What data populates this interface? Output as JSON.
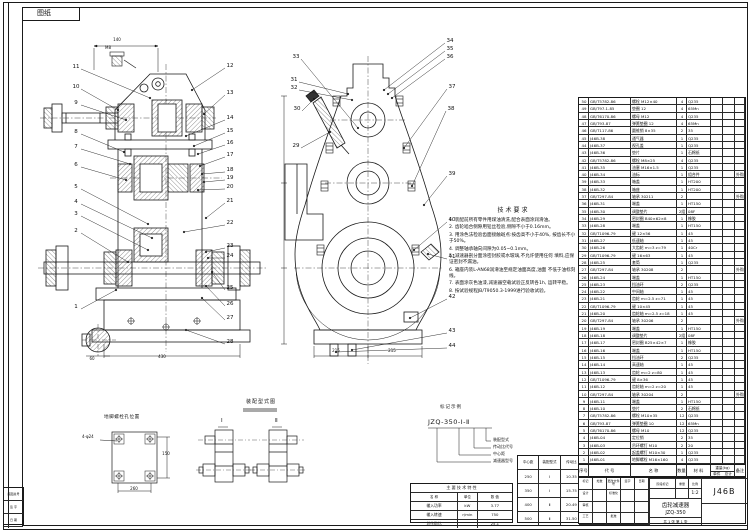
{
  "sheet": {
    "corner_tab": "图纸",
    "bottom_left_rows": [
      "底图总号",
      "签 字",
      "日 期"
    ],
    "line_color": "#1a1a1a",
    "paper_color": "#ffffff"
  },
  "front_view": {
    "name": "减速器主视剖视图",
    "detail_label": "M8",
    "callouts_left": [
      {
        "n": "11",
        "x": 76,
        "y": 68,
        "tx": 150,
        "ty": 98
      },
      {
        "n": "10",
        "x": 76,
        "y": 88,
        "tx": 118,
        "ty": 110
      },
      {
        "n": "9",
        "x": 76,
        "y": 104,
        "tx": 126,
        "ty": 120
      },
      {
        "n": "8",
        "x": 76,
        "y": 133,
        "tx": 124,
        "ty": 152
      },
      {
        "n": "7",
        "x": 76,
        "y": 148,
        "tx": 130,
        "ty": 164
      },
      {
        "n": "6",
        "x": 76,
        "y": 166,
        "tx": 126,
        "ty": 180
      },
      {
        "n": "5",
        "x": 76,
        "y": 188,
        "tx": 148,
        "ty": 224
      },
      {
        "n": "4",
        "x": 76,
        "y": 203,
        "tx": 152,
        "ty": 238
      },
      {
        "n": "3",
        "x": 76,
        "y": 215,
        "tx": 148,
        "ty": 250
      },
      {
        "n": "2",
        "x": 76,
        "y": 232,
        "tx": 128,
        "ty": 262
      },
      {
        "n": "1",
        "x": 76,
        "y": 308,
        "tx": 116,
        "ty": 290
      }
    ],
    "callouts_right": [
      {
        "n": "12",
        "x": 230,
        "y": 67,
        "tx": 192,
        "ty": 90
      },
      {
        "n": "13",
        "x": 230,
        "y": 94,
        "tx": 204,
        "ty": 114
      },
      {
        "n": "14",
        "x": 230,
        "y": 119,
        "tx": 186,
        "ty": 136
      },
      {
        "n": "15",
        "x": 230,
        "y": 132,
        "tx": 194,
        "ty": 146
      },
      {
        "n": "16",
        "x": 230,
        "y": 144,
        "tx": 198,
        "ty": 154
      },
      {
        "n": "17",
        "x": 230,
        "y": 156,
        "tx": 200,
        "ty": 166
      },
      {
        "n": "18",
        "x": 230,
        "y": 171,
        "tx": 202,
        "ty": 174
      },
      {
        "n": "19",
        "x": 230,
        "y": 179,
        "tx": 204,
        "ty": 182
      },
      {
        "n": "20",
        "x": 230,
        "y": 188,
        "tx": 198,
        "ty": 190
      },
      {
        "n": "21",
        "x": 230,
        "y": 202,
        "tx": 206,
        "ty": 218
      },
      {
        "n": "22",
        "x": 230,
        "y": 224,
        "tx": 184,
        "ty": 232
      },
      {
        "n": "23",
        "x": 230,
        "y": 247,
        "tx": 206,
        "ty": 252
      },
      {
        "n": "24",
        "x": 230,
        "y": 257,
        "tx": 208,
        "ty": 258
      },
      {
        "n": "25",
        "x": 230,
        "y": 289,
        "tx": 212,
        "ty": 272
      },
      {
        "n": "26",
        "x": 230,
        "y": 305,
        "tx": 206,
        "ty": 286
      },
      {
        "n": "27",
        "x": 230,
        "y": 319,
        "tx": 202,
        "ty": 298
      },
      {
        "n": "28",
        "x": 230,
        "y": 343,
        "tx": 186,
        "ty": 330
      }
    ]
  },
  "side_view": {
    "name": "减速器侧视图",
    "callouts_left": [
      {
        "n": "33",
        "x": 296,
        "y": 58,
        "tx": 358,
        "ty": 128
      },
      {
        "n": "31",
        "x": 294,
        "y": 81,
        "tx": 348,
        "ty": 94
      },
      {
        "n": "32",
        "x": 294,
        "y": 89,
        "tx": 352,
        "ty": 100
      },
      {
        "n": "30",
        "x": 297,
        "y": 110,
        "tx": 314,
        "ty": 99
      },
      {
        "n": "29",
        "x": 296,
        "y": 147,
        "tx": 330,
        "ty": 132
      }
    ],
    "callouts_right": [
      {
        "n": "34",
        "x": 450,
        "y": 42,
        "tx": 384,
        "ty": 90
      },
      {
        "n": "35",
        "x": 450,
        "y": 50,
        "tx": 388,
        "ty": 94
      },
      {
        "n": "36",
        "x": 450,
        "y": 58,
        "tx": 392,
        "ty": 98
      },
      {
        "n": "37",
        "x": 452,
        "y": 88,
        "tx": 404,
        "ty": 148
      },
      {
        "n": "38",
        "x": 451,
        "y": 110,
        "tx": 412,
        "ty": 186
      },
      {
        "n": "39",
        "x": 452,
        "y": 175,
        "tx": 424,
        "ty": 205
      },
      {
        "n": "40",
        "x": 452,
        "y": 221,
        "tx": 414,
        "ty": 250
      },
      {
        "n": "41",
        "x": 452,
        "y": 258,
        "tx": 428,
        "ty": 254
      },
      {
        "n": "42",
        "x": 452,
        "y": 298,
        "tx": 410,
        "ty": 318
      },
      {
        "n": "43",
        "x": 452,
        "y": 332,
        "tx": 352,
        "ty": 350
      },
      {
        "n": "44",
        "x": 452,
        "y": 347,
        "tx": 336,
        "ty": 352
      }
    ]
  },
  "dims": [
    {
      "t": "140",
      "x": 117,
      "y": 40
    },
    {
      "t": "M8",
      "x": 108,
      "y": 48
    },
    {
      "t": "430",
      "x": 162,
      "y": 357
    },
    {
      "t": "60",
      "x": 92,
      "y": 359
    },
    {
      "t": "215",
      "x": 336,
      "y": 351
    },
    {
      "t": "215",
      "x": 392,
      "y": 351
    },
    {
      "t": "260",
      "x": 134,
      "y": 489
    },
    {
      "t": "150",
      "x": 166,
      "y": 454
    }
  ],
  "notes": {
    "title": "技术要求",
    "items": [
      "1. 装配前所有零件用煤油清洗,配合表面涂润滑油。",
      "2. 齿轮啮合侧隙用铅丝检验,侧隙不小于0.16mm。",
      "3. 用涂色法检验齿面接触斑点:按齿高不小于40%, 按齿长不小于50%。",
      "4. 调整轴承轴向间隙为0.05~0.1mm。",
      "5. 减速器剖分面涂密封胶或水玻璃,不允许使用任何 填料,应保证密封不漏油。",
      "6. 箱座内装L-AN68润滑油至规定油面高度,油面 不低于油标刻线。",
      "7. 表面涂灰色油漆,减速器空载试验正反转各1h, 运转平稳。",
      "8. 按试验规程JB/T9050.3-1999进行验收试验。"
    ]
  },
  "designation": {
    "title": "标记示例",
    "code": "JZQ-350-Ⅰ-Ⅱ",
    "labels": [
      "装配型式",
      "传动比代号",
      "中心距",
      "减速器型号"
    ]
  },
  "variant_table": {
    "headers": [
      "中心距",
      "装配型式",
      "传动比"
    ],
    "rows": [
      [
        "250",
        "Ⅰ",
        "10.35"
      ],
      [
        "350",
        "Ⅰ",
        "15.75"
      ],
      [
        "400",
        "Ⅱ",
        "20.49"
      ],
      [
        "500",
        "Ⅱ",
        "31.50"
      ]
    ]
  },
  "spec_table": {
    "title": "主 要 技 术 特 性",
    "headers": [
      "名  称",
      "单位",
      "数  值"
    ],
    "rows": [
      [
        "输入功率",
        "kW",
        "3.77"
      ],
      [
        "输入转速",
        "r/min",
        "750"
      ],
      [
        "总传动比",
        "",
        "25.1"
      ]
    ]
  },
  "plate_view": {
    "title": "地脚螺栓孔位置",
    "hole_label": "4-φ24"
  },
  "assembly_types": {
    "title": "装配型式图",
    "variants": [
      "Ⅰ",
      "Ⅱ"
    ]
  },
  "bom": {
    "headers": [
      "序号",
      "代  号",
      "名  称",
      "数量",
      "材 料",
      "备注"
    ],
    "weight_label": "重量(kg)",
    "weight_sub": [
      "单件",
      "总计"
    ],
    "rows": [
      [
        "50",
        "GB/T5782-86",
        "螺栓 M12×40",
        "4",
        "Q235",
        "",
        "",
        ""
      ],
      [
        "49",
        "GB/T97.1-85",
        "垫圈 12",
        "4",
        "65Mn",
        "",
        "",
        ""
      ],
      [
        "48",
        "GB/T6170-86",
        "螺母 M12",
        "4",
        "Q235",
        "",
        "",
        ""
      ],
      [
        "47",
        "GB/T93-87",
        "弹簧垫圈 12",
        "4",
        "65Mn",
        "",
        "",
        ""
      ],
      [
        "46",
        "GB/T117-86",
        "圆锥销 8×35",
        "2",
        "35",
        "",
        "",
        ""
      ],
      [
        "45",
        "J46B-38",
        "通气器",
        "1",
        "Q235",
        "",
        "",
        ""
      ],
      [
        "44",
        "J46B-37",
        "视孔盖",
        "1",
        "Q235",
        "",
        "",
        ""
      ],
      [
        "43",
        "J46B-36",
        "垫片",
        "1",
        "石棉纸",
        "",
        "",
        ""
      ],
      [
        "42",
        "GB/T5782-86",
        "螺栓 M8×25",
        "4",
        "Q235",
        "",
        "",
        ""
      ],
      [
        "41",
        "J46B-35",
        "油塞 M16×1.5",
        "1",
        "Q235",
        "",
        "",
        ""
      ],
      [
        "40",
        "J46B-34",
        "油标",
        "1",
        "组合件",
        "",
        "",
        "外购"
      ],
      [
        "39",
        "J46B-33",
        "箱盖",
        "1",
        "HT200",
        "",
        "",
        ""
      ],
      [
        "38",
        "J46B-32",
        "箱座",
        "1",
        "HT200",
        "",
        "",
        ""
      ],
      [
        "37",
        "GB/T297-84",
        "轴承 30211",
        "2",
        "",
        "",
        "",
        "外购"
      ],
      [
        "36",
        "J46B-31",
        "端盖",
        "1",
        "HT150",
        "",
        "",
        ""
      ],
      [
        "35",
        "J46B-30",
        "调整垫片",
        "2组",
        "08F",
        "",
        "",
        ""
      ],
      [
        "34",
        "J46B-29",
        "密封圈 B40×62×8",
        "1",
        "橡胶",
        "",
        "",
        ""
      ],
      [
        "33",
        "J46B-28",
        "端盖",
        "1",
        "HT150",
        "",
        "",
        ""
      ],
      [
        "32",
        "GB/T1096-79",
        "键 12×56",
        "1",
        "45",
        "",
        "",
        ""
      ],
      [
        "31",
        "J46B-27",
        "低速轴",
        "1",
        "45",
        "",
        "",
        ""
      ],
      [
        "30",
        "J46B-26",
        "大齿轮 m=3 z=79",
        "1",
        "40Cr",
        "",
        "",
        ""
      ],
      [
        "29",
        "GB/T1096-79",
        "键 16×63",
        "1",
        "45",
        "",
        "",
        ""
      ],
      [
        "28",
        "J46B-25",
        "套筒",
        "1",
        "Q235",
        "",
        "",
        ""
      ],
      [
        "27",
        "GB/T297-84",
        "轴承 30208",
        "2",
        "",
        "",
        "",
        "外购"
      ],
      [
        "26",
        "J46B-24",
        "端盖",
        "1",
        "HT150",
        "",
        "",
        ""
      ],
      [
        "25",
        "J46B-23",
        "挡油环",
        "2",
        "Q235",
        "",
        "",
        ""
      ],
      [
        "24",
        "J46B-22",
        "中间轴",
        "1",
        "45",
        "",
        "",
        ""
      ],
      [
        "23",
        "J46B-21",
        "齿轮 m=2.5 z=71",
        "1",
        "45",
        "",
        "",
        ""
      ],
      [
        "22",
        "GB/T1096-79",
        "键 10×45",
        "1",
        "45",
        "",
        "",
        ""
      ],
      [
        "21",
        "J46B-20",
        "齿轮轴 m=2.5 z=18",
        "1",
        "45",
        "",
        "",
        ""
      ],
      [
        "20",
        "GB/T297-84",
        "轴承 30206",
        "2",
        "",
        "",
        "",
        "外购"
      ],
      [
        "19",
        "J46B-19",
        "端盖",
        "1",
        "HT150",
        "",
        "",
        ""
      ],
      [
        "18",
        "J46B-18",
        "调整垫片",
        "2组",
        "08F",
        "",
        "",
        ""
      ],
      [
        "17",
        "J46B-17",
        "密封圈 B25×42×7",
        "1",
        "橡胶",
        "",
        "",
        ""
      ],
      [
        "16",
        "J46B-16",
        "端盖",
        "1",
        "HT150",
        "",
        "",
        ""
      ],
      [
        "15",
        "J46B-15",
        "挡油环",
        "2",
        "Q235",
        "",
        "",
        ""
      ],
      [
        "14",
        "J46B-14",
        "高速轴",
        "1",
        "45",
        "",
        "",
        ""
      ],
      [
        "13",
        "J46B-13",
        "齿轮 m=2 z=80",
        "1",
        "45",
        "",
        "",
        ""
      ],
      [
        "12",
        "GB/T1096-79",
        "键 8×36",
        "1",
        "45",
        "",
        "",
        ""
      ],
      [
        "11",
        "J46B-12",
        "齿轮轴 m=2 z=20",
        "1",
        "45",
        "",
        "",
        ""
      ],
      [
        "10",
        "GB/T297-84",
        "轴承 30204",
        "2",
        "",
        "",
        "",
        "外购"
      ],
      [
        "9",
        "J46B-11",
        "端盖",
        "1",
        "HT150",
        "",
        "",
        ""
      ],
      [
        "8",
        "J46B-10",
        "垫片",
        "2",
        "石棉纸",
        "",
        "",
        ""
      ],
      [
        "7",
        "GB/T5782-86",
        "螺栓 M10×35",
        "12",
        "Q235",
        "",
        "",
        ""
      ],
      [
        "6",
        "GB/T93-87",
        "弹簧垫圈 10",
        "12",
        "65Mn",
        "",
        "",
        ""
      ],
      [
        "5",
        "GB/T6170-86",
        "螺母 M10",
        "12",
        "Q235",
        "",
        "",
        ""
      ],
      [
        "4",
        "J46B-04",
        "定位销",
        "2",
        "35",
        "",
        "",
        ""
      ],
      [
        "3",
        "J46B-03",
        "吊环螺钉 M10",
        "2",
        "20",
        "",
        "",
        ""
      ],
      [
        "2",
        "J46B-02",
        "起盖螺钉 M10×30",
        "1",
        "Q235",
        "",
        "",
        ""
      ],
      [
        "1",
        "J46B-01",
        "地脚螺栓 M16×160",
        "4",
        "Q235",
        "",
        "",
        ""
      ]
    ]
  },
  "title_block": {
    "drawing_no": "J46B",
    "product_name": "齿轮减速器",
    "product_code": "JZQ-350",
    "stage_label": "阶段标记",
    "weight_label": "重量",
    "scale_label": "比例",
    "scale": "1:2",
    "sheet_label": "共 1 张  第 1 张",
    "left_grid": [
      [
        "标记",
        "处数",
        "更改文件号",
        "签字",
        "日期"
      ],
      [
        "设计",
        "",
        "标准化",
        "",
        ""
      ],
      [
        "审核",
        "",
        "",
        "",
        ""
      ],
      [
        "工艺",
        "",
        "批准",
        "",
        ""
      ]
    ]
  }
}
